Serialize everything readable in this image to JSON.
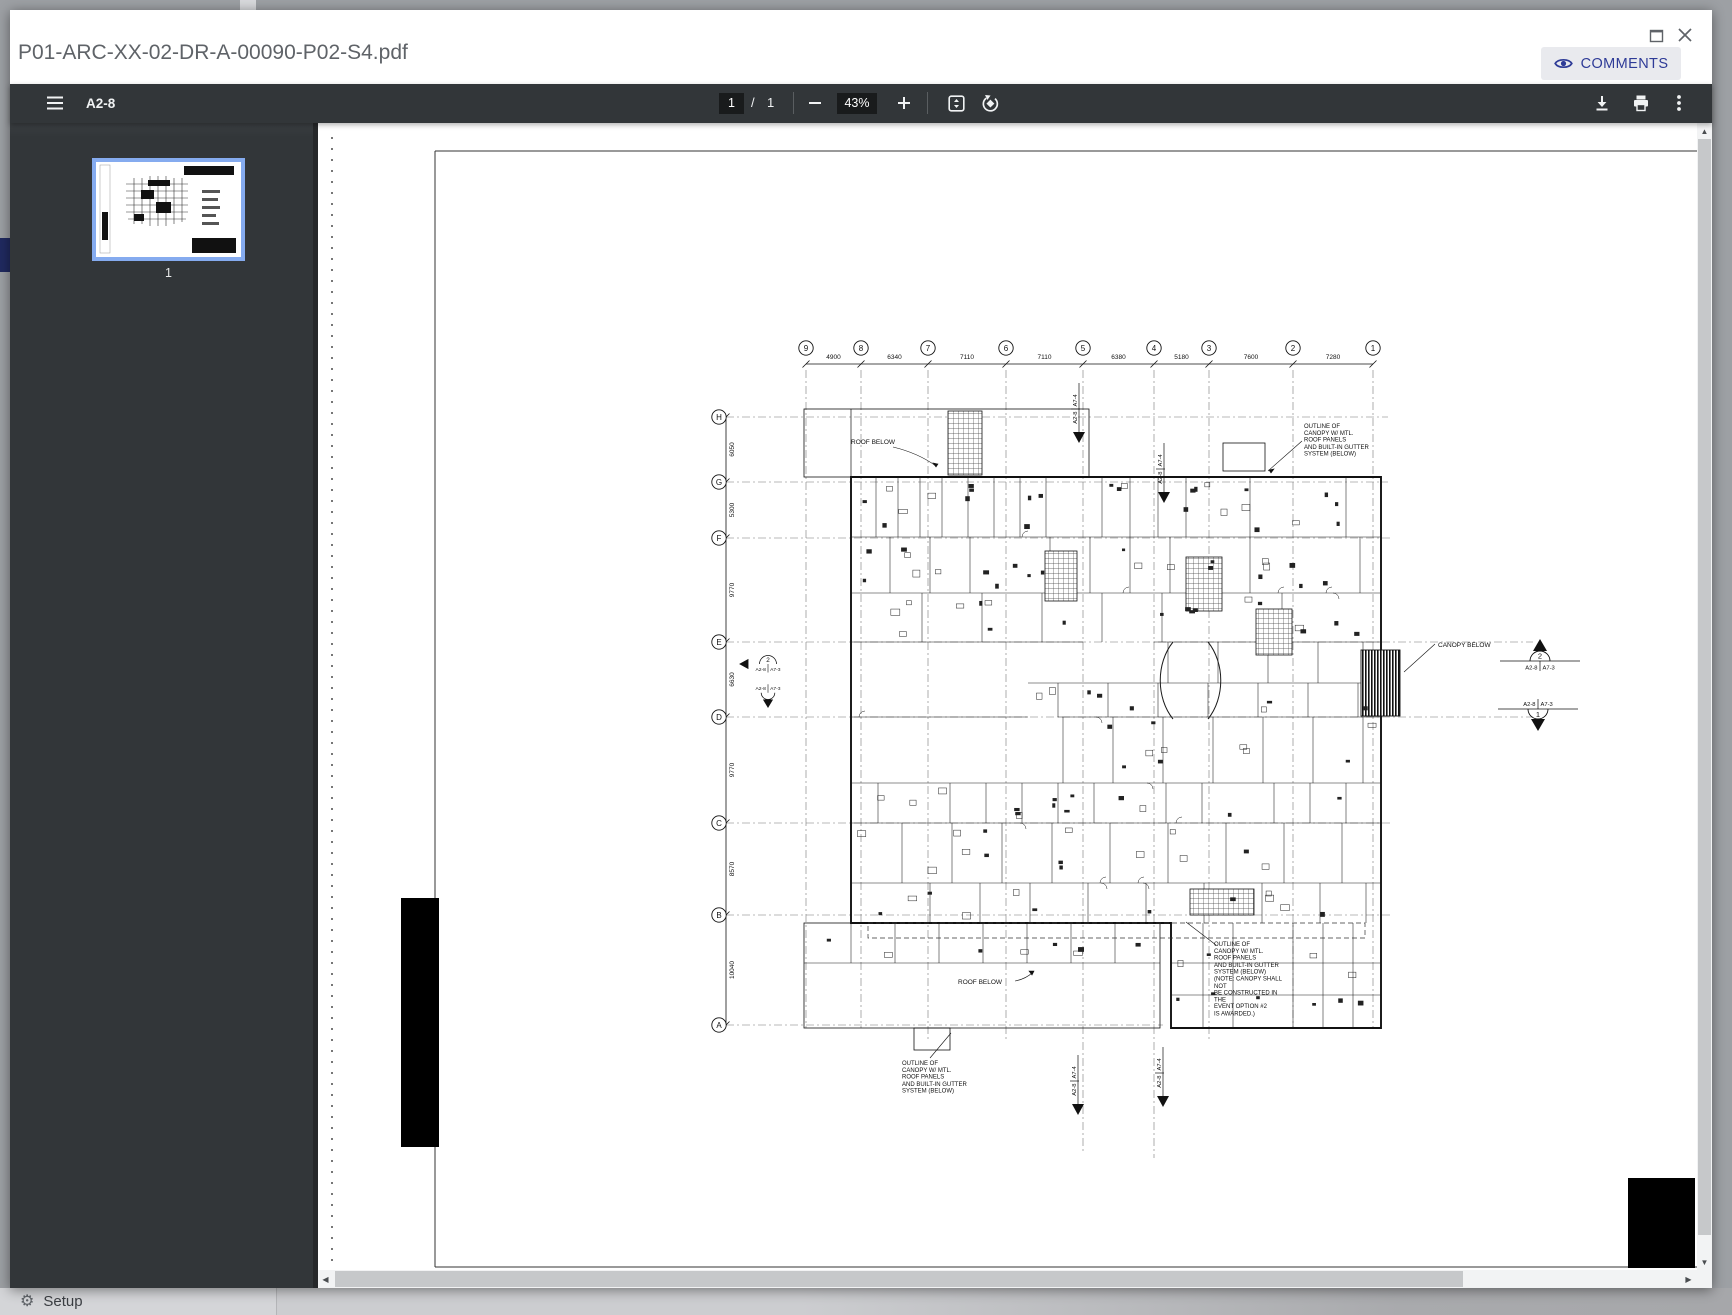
{
  "window": {
    "title": "P01-ARC-XX-02-DR-A-00090-P02-S4.pdf",
    "comments_label": "COMMENTS"
  },
  "toolbar": {
    "doc_code": "A2-8",
    "page_current": "1",
    "page_separator": "/",
    "page_total": "1",
    "zoom_level": "43%"
  },
  "sidebar": {
    "thumbnail_page_number": "1"
  },
  "statusbar": {
    "setup_label": "Setup"
  },
  "colors": {
    "toolbar_bg": "#323639",
    "value_box_bg": "#191b1c",
    "comments_accent": "#2e3b97",
    "thumbnail_selection": "#85abef",
    "backdrop": "#9da0a4",
    "nav_indicator": "#202a60"
  },
  "drawing": {
    "grid_columns": {
      "labels": [
        "9",
        "8",
        "7",
        "6",
        "5",
        "4",
        "3",
        "2",
        "1"
      ],
      "x": [
        488,
        543,
        610,
        688,
        765,
        836,
        891,
        975,
        1055
      ],
      "dims": [
        "4900",
        "6340",
        "7110",
        "7110",
        "6380",
        "5180",
        "7600",
        "7280"
      ]
    },
    "grid_rows": {
      "labels": [
        "H",
        "G",
        "F",
        "E",
        "D",
        "C",
        "B",
        "A"
      ],
      "y": [
        294,
        359,
        415,
        519,
        594,
        700,
        792,
        902
      ],
      "dims": [
        "6050",
        "5300",
        "9770",
        "6630",
        "9770",
        "8570",
        "10040"
      ]
    },
    "labels": {
      "roof_below_upper": "ROOF BELOW",
      "roof_below_lower": "ROOF BELOW",
      "canopy_below": "CANOPY BELOW"
    },
    "notes": {
      "top_right": "OUTLINE OF\nCANOPY W/ MTL.\nROOF PANELS\nAND BUILT-IN GUTTER\nSYSTEM (BELOW)",
      "bottom_center": "OUTLINE OF\nCANOPY W/ MTL.\nROOF PANELS\nAND BUILT-IN GUTTER\nSYSTEM (BELOW)",
      "bottom_right": "OUTLINE OF\nCANOPY W/ MTL.\nROOF PANELS\nAND BUILT-IN GUTTER\nSYSTEM (BELOW)\n(NOTE: CANOPY SHALL NOT\nBE CONSTRUCTED IN THE\nEVENT OPTION #2\nIS AWARDED.)"
    },
    "section_markers": {
      "sheet_ref": "A2-8",
      "detail_ref_side": "A7-3",
      "detail_ref_vert": "A7-4",
      "upper_number": "2",
      "lower_number": "1"
    }
  }
}
